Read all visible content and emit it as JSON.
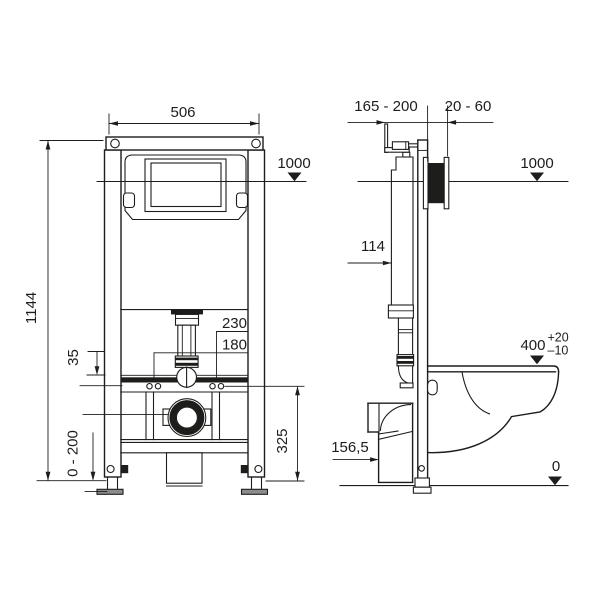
{
  "drawing": {
    "front_view": {
      "frame_width": "506",
      "reference_line_height": "1000",
      "frame_total_height": "1144",
      "fixing_offset": "35",
      "fixing_hole_spacing_outer": "230",
      "fixing_hole_spacing_inner": "180",
      "leg_adjustment_range": "0 - 200",
      "waste_outlet_height": "325"
    },
    "side_view": {
      "wall_bracket_range": "165 - 200",
      "finished_wall_range": "20 - 60",
      "reference_line_height": "1000",
      "flush_pipe_offset": "114",
      "bowl_top_height": "400",
      "bowl_top_tolerance_plus": "+20",
      "bowl_top_tolerance_minus": "–10",
      "waste_outlet_offset": "156,5",
      "floor_level": "0"
    }
  }
}
